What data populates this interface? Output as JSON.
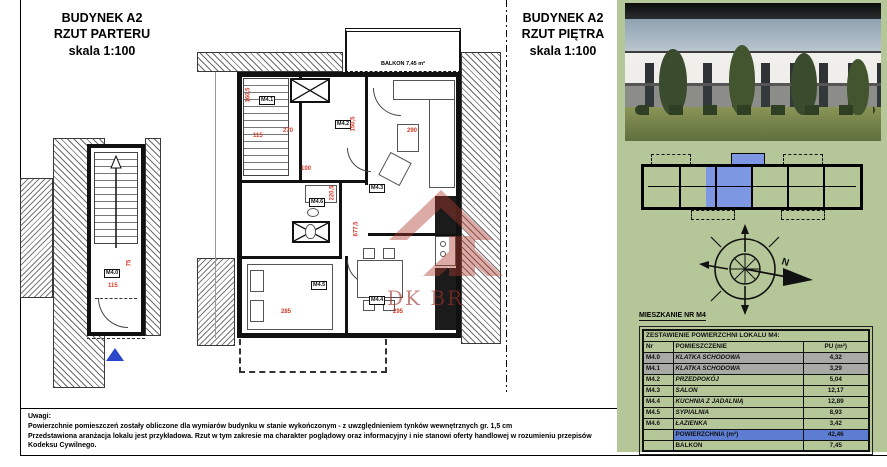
{
  "titles": {
    "left": [
      "BUDYNEK A2",
      "RZUT PARTERU",
      "skala 1:100"
    ],
    "right": [
      "BUDYNEK A2",
      "RZUT PIĘTRA",
      "skala 1:100"
    ]
  },
  "plan_left": {
    "room": "M4.0",
    "dims": [
      "75",
      "115"
    ]
  },
  "plan_main": {
    "balcony": "BALKON 7,45 m²",
    "rooms": {
      "m41": "M4.1",
      "m42": "M4.2",
      "m43": "M4.3",
      "m44": "M4.4",
      "m45": "M4.5",
      "m46": "M4.6"
    },
    "dims": [
      "160,5",
      "115",
      "270",
      "150,5",
      "290",
      "100",
      "220,5",
      "677,5",
      "285",
      "295"
    ]
  },
  "watermark": {
    "text": "DK BR"
  },
  "compass": {
    "north": "N"
  },
  "panel": {
    "apartment_label": "MIESZKANIE NR M4",
    "table": {
      "caption": "ZESTAWIENIE POWIERZCHNI LOKALU M4:",
      "headers": [
        "Nr",
        "POMIESZCZENIE",
        "PU (m²)"
      ],
      "rows": [
        {
          "nr": "M4.0",
          "name": "KLATKA SCHODOWA",
          "pu": "4,32"
        },
        {
          "nr": "M4.1",
          "name": "KLATKA SCHODOWA",
          "pu": "3,29"
        },
        {
          "nr": "M4.2",
          "name": "PRZEDPOKÓJ",
          "pu": "5,04"
        },
        {
          "nr": "M4.3",
          "name": "SALON",
          "pu": "12,17"
        },
        {
          "nr": "M4.4",
          "name": "KUCHNIA Z JADALNIĄ",
          "pu": "12,89"
        },
        {
          "nr": "M4.5",
          "name": "SYPIALNIA",
          "pu": "8,93"
        },
        {
          "nr": "M4.6",
          "name": "ŁAZIENKA",
          "pu": "3,42"
        }
      ],
      "total_label": "POWIERZCHNIA (m²)",
      "total_value": "42,46",
      "balcony_label": "BALKON",
      "balcony_value": "7,45"
    }
  },
  "footer": {
    "label": "Uwagi:",
    "line1": "Powierzchnie pomieszczeń zostały obliczone dla wymiarów budynku w stanie wykończonym - z uwzględnieniem tynków wewnętrznych gr. 1,5 cm",
    "line2": "Przedstawiona aranżacja lokalu jest przykładowa. Rzut w tym zakresie ma charakter poglądowy oraz informacyjny i nie stanowi oferty handlowej w rozumieniu przepisów",
    "line3": "Kodeksu Cywilnego."
  },
  "colors": {
    "panel_green": "#b5c698",
    "highlight_blue": "#5d7dd2",
    "siteplan_blue": "#7e97e3",
    "dim_red": "#d43a28",
    "gray_row": "#a9a9a5"
  }
}
